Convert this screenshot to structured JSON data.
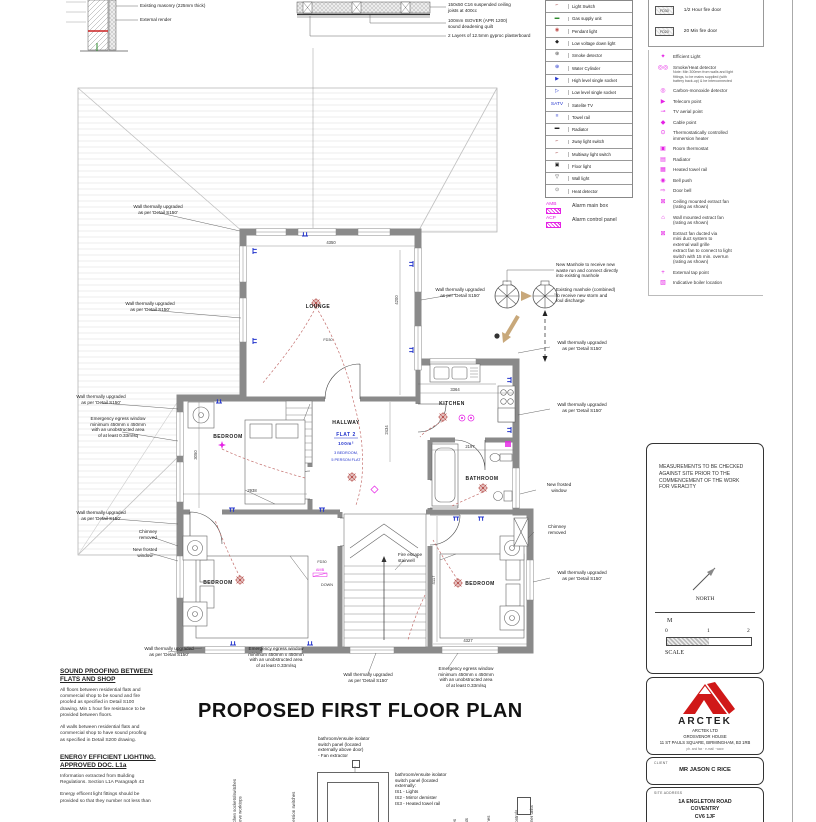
{
  "colors": {
    "magenta": "#e522e5",
    "blue": "#2233cc",
    "red": "#b85450",
    "wall": "#8a8a8a",
    "logo_red": "#d01818"
  },
  "wall_detail": {
    "label1": "Existing masonry (225mm thick)",
    "label2": "External render"
  },
  "ceiling_detail": {
    "label1": "150x50 C16 suspended ceiling\njoists at 400cc",
    "label2": "100mm ISOVER (APR 1200)\nsound deadening quilt",
    "label3": "2 Layers of 12.5mm gyproc plasterboard"
  },
  "electrical_legend": {
    "items": [
      {
        "symbol": "⌐",
        "color": "#a04040",
        "label": "Light Switch"
      },
      {
        "symbol": "▬",
        "color": "#2e8b2e",
        "label": "Gas supply unit"
      },
      {
        "symbol": "◉",
        "color": "#c0504d",
        "label": "Pendant light"
      },
      {
        "symbol": "◆",
        "color": "#222222",
        "label": "Low voltage down light"
      },
      {
        "symbol": "⊛",
        "color": "#444444",
        "label": "Smoke detector"
      },
      {
        "symbol": "⊕",
        "color": "#2233cc",
        "label": "Water Cylinder"
      },
      {
        "symbol": "▶",
        "color": "#2233cc",
        "label": "High level single socket"
      },
      {
        "symbol": "▷",
        "color": "#2233cc",
        "label": "Low level single socket"
      },
      {
        "symbol": "SATV",
        "color": "#2233cc",
        "label": "Satelite TV"
      },
      {
        "symbol": "≡",
        "color": "#2233cc",
        "label": "Towel rail"
      },
      {
        "symbol": "▬",
        "color": "#222222",
        "label": "Radiator"
      },
      {
        "symbol": "⌐",
        "color": "#a04040",
        "label": "2way light switch"
      },
      {
        "symbol": "⌐",
        "color": "#a04040",
        "label": "Multiway light switch"
      },
      {
        "symbol": "▣",
        "color": "#222222",
        "label": "Floor light"
      },
      {
        "symbol": "▽",
        "color": "#222222",
        "label": "Wall light"
      },
      {
        "symbol": "⊙",
        "color": "#666666",
        "label": "Heat detector"
      }
    ]
  },
  "alarm_legend": {
    "amb_code": "AMB",
    "amb_label": "Alarm main box",
    "acp_code": "ACP",
    "acp_label": "Alarm control panel"
  },
  "fire_legend": {
    "items": [
      {
        "code": "FD30",
        "label": "1/2 Hour fire door"
      },
      {
        "code": "FD20",
        "label": "20 Min fire door"
      }
    ]
  },
  "services_legend": {
    "items": [
      {
        "symbol": "✦",
        "label": "Efficient Light"
      },
      {
        "symbol": "◎◎",
        "label": "Smoke/Heat detector",
        "note": "Note: Min 300mm from walls and light\nfittings, to be mains supplied (with\nbattery back-up) & be interconnected"
      },
      {
        "symbol": "◎",
        "label": "Carbon-monoxide detector"
      },
      {
        "symbol": "▶",
        "label": "Telecom point"
      },
      {
        "symbol": "⊸",
        "label": "TV aerial point"
      },
      {
        "symbol": "◆",
        "label": "Cable point"
      },
      {
        "symbol": "⊙",
        "label": "Thermostatically controlled\nimmersion heater"
      },
      {
        "symbol": "▣",
        "label": "Room thermostat"
      },
      {
        "symbol": "▤",
        "label": "Radiator"
      },
      {
        "symbol": "▦",
        "label": "Heated towel rail"
      },
      {
        "symbol": "◉",
        "label": "Bell push"
      },
      {
        "symbol": "⇨",
        "label": "Door bell"
      },
      {
        "symbol": "⊠",
        "label": "Ceiling mounted extract fan\n(rating as shown)"
      },
      {
        "symbol": "⌂",
        "label": "Wall mounted extract fan\n(rating as shown)"
      },
      {
        "symbol": "⊠",
        "label": "Extract fan ducted via\nmini duct system to\nexternal wall grille\nextract fan to connect to light\nswitch with 15 min. overrun\n(rating as shown)"
      },
      {
        "symbol": "+",
        "label": "External tap point"
      },
      {
        "symbol": "▧",
        "label": "Indicative boiler location"
      }
    ]
  },
  "plan": {
    "rooms": {
      "lounge": "LOUNGE",
      "bedroom1": "BEDROOM",
      "bedroom2": "BEDROOM",
      "bedroom3": "BEDROOM",
      "hallway": "HALLWAY",
      "kitchen": "KITCHEN",
      "bathroom": "BATHROOM",
      "flat": "FLAT 2",
      "flat_area": "100m²",
      "flat_line1": "3 BEDROOM,",
      "flat_line2": "5 PERSON FLAT",
      "down": "DOWN",
      "fd30": "FD30",
      "amb": "AMB"
    },
    "dims": {
      "lounge_w": "4350",
      "lounge_h": "4200",
      "kitchen_w": "3364",
      "hall_h": "2434",
      "bath_w": "2197",
      "bed1_w": "2938",
      "bed1_h": "3050",
      "bed3_h": "4117",
      "bed3_w": "4327"
    },
    "annotations": {
      "wall_upgraded": "Wall thermally upgraded\nas per 'Detail S150'",
      "egress": "Emergency egress window\nminimum 450mm x 450mm\nwith an unobstructed area\nof at least 0.33m/sq",
      "chimney": "Chimney\nremoved",
      "frosted": "New frosted\nwindow",
      "manhole_new": "New Manhole to receive new\nwaste run and connect directly\ninto existing manhole",
      "manhole_existing": "Existing manhole (combined)\nto receive new storm and\nfoul discharge",
      "fire_escape": "Fire escape\nstairwell"
    }
  },
  "notes_left": {
    "title1": "SOUND PROOFING BETWEEN\nFLATS AND SHOP",
    "p1": "All floors between residential flats and\ncommercial shop to be sound and fire\nproofed as specified in Detail S100\ndrawing. Min 1 hour fire resistance to be\nprovided between floors.",
    "p2": "All walls between residential flats and\ncommercial shop to have sound proofing\nas specified in Detail S200 drawing.",
    "title2": "ENERGY EFFICIENT LIGHTING.\nAPPROVED DOC. L1a",
    "p3": "Information extracted from Building\nRegulations. Section L1A Paragraph 43",
    "p4": "Energy efficent light fittings should be\nprovided so that they number not less than"
  },
  "main_title": "PROPOSED FIRST FLOOR PLAN",
  "heights": {
    "note_top": "bathroom/ensuite isolator\nswitch panel (located\nexternally above door)\n- Fan extractor",
    "note_right": "bathroom/ensuite isolator\nswitch panel (located\nexternally:\nIS1 - Lights\nIS2 - Mirror demister\nIS3 - Heated towel rail",
    "rotated": [
      "kitchen sockets/switches\nabove worktops",
      "immersion switches",
      "light switches",
      "thermostats",
      "door bells",
      "entry phones",
      "boiler controls",
      "consumer units"
    ]
  },
  "sidebar": {
    "measurements_note": "MEASUREMENTS TO BE CHECKED\nAGAINST SITE PRIOR TO THE\nCOMMENCEMENT OF THE WORK\nFOR VERACITY",
    "north_label": "NORTH",
    "scale_unit": "M",
    "scale_t0": "0",
    "scale_t1": "1",
    "scale_t2": "2",
    "scale_label": "SCALE",
    "firm_name": "ARCTEK",
    "firm_line1": "ARCTEK LTD",
    "firm_line2": "GROSVENOR HOUSE",
    "firm_line3": "11 ST PAULS SQUARE, BIRMINGHAM, B3 1RB",
    "firm_contact": "ph. and fax · e-mail · www",
    "client_label": "CLIENT",
    "client_name": "MR JASON C RICE",
    "site_label": "SITE ADDRESS",
    "site_line1": "1A ENGLETON ROAD",
    "site_line2": "COVENTRY",
    "site_line3": "CV6 1JF"
  }
}
